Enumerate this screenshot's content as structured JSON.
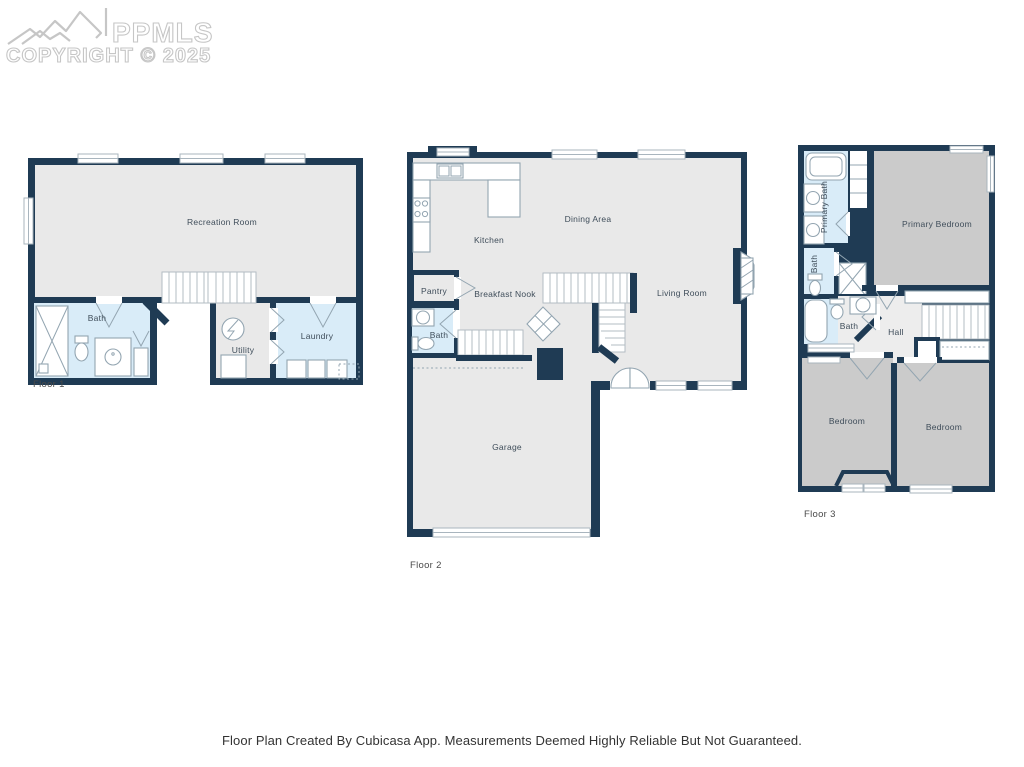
{
  "watermark": {
    "brand": "PPMLS",
    "copyright": "COPYRIGHT © 2025",
    "logo": "mountain-logo"
  },
  "footer": {
    "disclaimer": "Floor Plan Created By Cubicasa App. Measurements Deemed Highly Reliable But Not Guaranteed."
  },
  "colors": {
    "wall": "#1f3b54",
    "room": "#e9e9e9",
    "bedroom": "#cbcbcb",
    "wet": "#d9ecf8",
    "hall": "#ededed",
    "fixture": "#93a5b1",
    "window": "#a9b5be",
    "stair": "#b3bcc3",
    "label": "#3f4d5a",
    "watermark": "#c6c6c6"
  },
  "floors": [
    {
      "label": "Floor 1",
      "rooms": {
        "recreation": "Recreation Room",
        "bath": "Bath",
        "utility": "Utility",
        "laundry": "Laundry"
      }
    },
    {
      "label": "Floor 2",
      "rooms": {
        "kitchen": "Kitchen",
        "dining": "Dining Area",
        "pantry": "Pantry",
        "breakfast": "Breakfast Nook",
        "bath": "Bath",
        "living": "Living Room",
        "garage": "Garage"
      }
    },
    {
      "label": "Floor 3",
      "rooms": {
        "primary_bath": "Primary Bath",
        "primary_bedroom": "Primary Bedroom",
        "bath_upper": "Bath",
        "bath_lower": "Bath",
        "hall": "Hall",
        "bedroom_left": "Bedroom",
        "bedroom_right": "Bedroom"
      }
    }
  ]
}
